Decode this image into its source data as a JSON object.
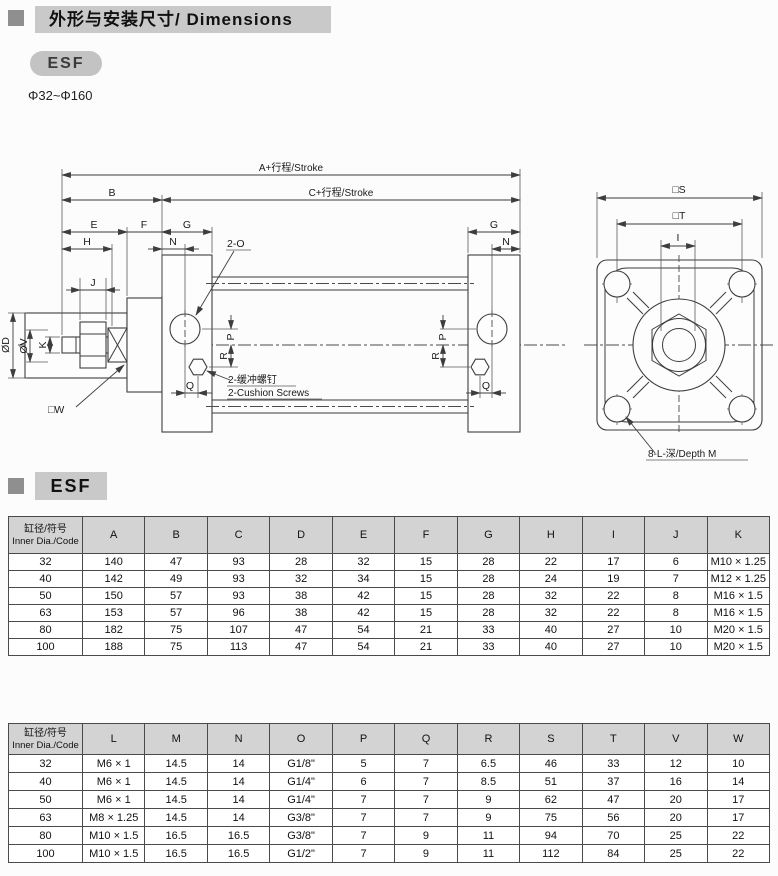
{
  "header": {
    "title": "外形与安装尺寸/ Dimensions",
    "badge": "ESF",
    "range": "Φ32~Φ160"
  },
  "section2": {
    "label": "ESF"
  },
  "colors": {
    "title_bar": "#c9c9c9",
    "marker_square": "#8f8f8f",
    "table_header": "#d3d3d3",
    "drawing_line": "#3d3d3d"
  },
  "drawing": {
    "dims": {
      "a": "A+行程/Stroke",
      "c": "C+行程/Stroke",
      "b": "B",
      "e": "E",
      "f": "F",
      "g": "G",
      "h": "H",
      "n": "N",
      "j": "J",
      "p": "P",
      "q": "Q",
      "r": "R",
      "i": "I",
      "s": "□S",
      "t": "□T",
      "od": "ØD",
      "ov": "ØV",
      "k": "K",
      "w": "□W"
    },
    "labels": {
      "port": "2-O",
      "cushion_cn": "2-缓冲螺钉",
      "cushion_en": "2-Cushion Screws",
      "depth": "8-L-深/Depth M"
    }
  },
  "table1": {
    "header_cn": "缸径/符号",
    "header_en": "Inner Dia./Code",
    "columns": [
      "A",
      "B",
      "C",
      "D",
      "E",
      "F",
      "G",
      "H",
      "I",
      "J",
      "K"
    ],
    "rows": [
      {
        "code": "32",
        "values": [
          "140",
          "47",
          "93",
          "28",
          "32",
          "15",
          "28",
          "22",
          "17",
          "6",
          "M10 × 1.25"
        ]
      },
      {
        "code": "40",
        "values": [
          "142",
          "49",
          "93",
          "32",
          "34",
          "15",
          "28",
          "24",
          "19",
          "7",
          "M12 × 1.25"
        ]
      },
      {
        "code": "50",
        "values": [
          "150",
          "57",
          "93",
          "38",
          "42",
          "15",
          "28",
          "32",
          "22",
          "8",
          "M16 × 1.5"
        ]
      },
      {
        "code": "63",
        "values": [
          "153",
          "57",
          "96",
          "38",
          "42",
          "15",
          "28",
          "32",
          "22",
          "8",
          "M16 × 1.5"
        ]
      },
      {
        "code": "80",
        "values": [
          "182",
          "75",
          "107",
          "47",
          "54",
          "21",
          "33",
          "40",
          "27",
          "10",
          "M20 × 1.5"
        ]
      },
      {
        "code": "100",
        "values": [
          "188",
          "75",
          "113",
          "47",
          "54",
          "21",
          "33",
          "40",
          "27",
          "10",
          "M20 × 1.5"
        ]
      }
    ]
  },
  "table2": {
    "header_cn": "缸径/符号",
    "header_en": "Inner Dia./Code",
    "columns": [
      "L",
      "M",
      "N",
      "O",
      "P",
      "Q",
      "R",
      "S",
      "T",
      "V",
      "W"
    ],
    "rows": [
      {
        "code": "32",
        "values": [
          "M6 × 1",
          "14.5",
          "14",
          "G1/8\"",
          "5",
          "7",
          "6.5",
          "46",
          "33",
          "12",
          "10"
        ]
      },
      {
        "code": "40",
        "values": [
          "M6 × 1",
          "14.5",
          "14",
          "G1/4\"",
          "6",
          "7",
          "8.5",
          "51",
          "37",
          "16",
          "14"
        ]
      },
      {
        "code": "50",
        "values": [
          "M6 × 1",
          "14.5",
          "14",
          "G1/4\"",
          "7",
          "7",
          "9",
          "62",
          "47",
          "20",
          "17"
        ]
      },
      {
        "code": "63",
        "values": [
          "M8 × 1.25",
          "14.5",
          "14",
          "G3/8\"",
          "7",
          "7",
          "9",
          "75",
          "56",
          "20",
          "17"
        ]
      },
      {
        "code": "80",
        "values": [
          "M10 × 1.5",
          "16.5",
          "16.5",
          "G3/8\"",
          "7",
          "9",
          "11",
          "94",
          "70",
          "25",
          "22"
        ]
      },
      {
        "code": "100",
        "values": [
          "M10 × 1.5",
          "16.5",
          "16.5",
          "G1/2\"",
          "7",
          "9",
          "11",
          "112",
          "84",
          "25",
          "22"
        ]
      }
    ]
  }
}
